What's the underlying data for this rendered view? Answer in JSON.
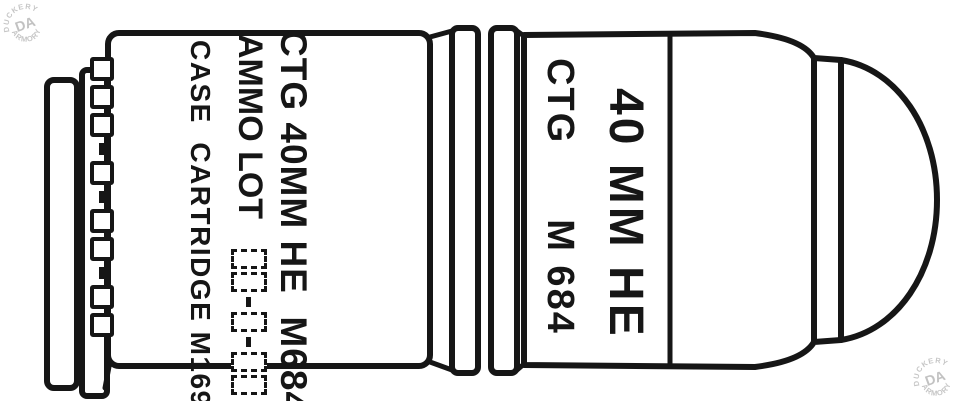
{
  "colors": {
    "ink": "#161616",
    "paper": "#ffffff",
    "watermark": "#c6c6c6"
  },
  "watermarks": {
    "center": "DA",
    "arc_top": "DUCKERY",
    "arc_bottom": "ARMORY"
  },
  "case": {
    "marking_line1": "CTG 40MM HE  M684",
    "ammo_lot_label": "AMMO LOT",
    "ammo_lot_pattern": "□□-□-□□",
    "marking_line3": "CASE  CARTRIDGE M169",
    "loading_lot_pattern": "□□□-□-□□-□□"
  },
  "projectile": {
    "marking_ctg": "CTG",
    "marking_model": "M 684",
    "marking_caliber": "40 MM HE"
  }
}
